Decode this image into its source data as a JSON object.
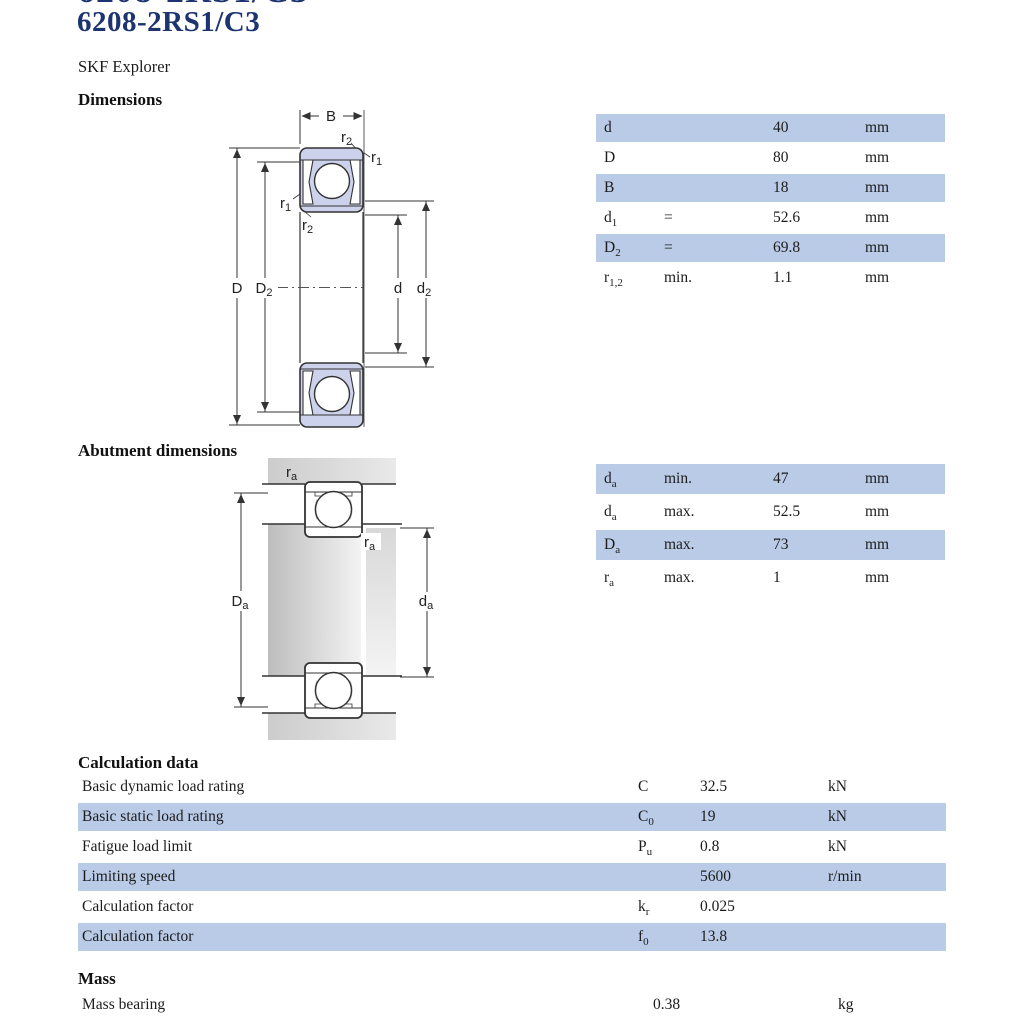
{
  "page": {
    "top_clipped_text": "6208-2RS1/C3",
    "title": "6208-2RS1/C3",
    "subtitle": "SKF Explorer"
  },
  "sections": {
    "dimensions": "Dimensions",
    "abutment": "Abutment dimensions",
    "calculation": "Calculation data",
    "mass": "Mass"
  },
  "colors": {
    "title_navy": "#1e3470",
    "row_highlight": "#b9cbe7",
    "drawing_fill": "#ccd2ec"
  },
  "figures": {
    "dimensions": {
      "labels": {
        "B": "B",
        "D": "D",
        "D2_base": "D",
        "D2_sub": "2",
        "d": "d",
        "d2_base": "d",
        "d2_sub": "2",
        "r1_base": "r",
        "r1_sub": "1",
        "r2_base": "r",
        "r2_sub": "2"
      }
    },
    "abutment": {
      "labels": {
        "Da_base": "D",
        "Da_sub": "a",
        "da_base": "d",
        "da_sub": "a",
        "ra_base": "r",
        "ra_sub": "a"
      }
    }
  },
  "tables": {
    "dimensions": {
      "rows": [
        {
          "sym": "d",
          "sub": "",
          "spec": "",
          "value": "40",
          "unit": "mm"
        },
        {
          "sym": "D",
          "sub": "",
          "spec": "",
          "value": "80",
          "unit": "mm"
        },
        {
          "sym": "B",
          "sub": "",
          "spec": "",
          "value": "18",
          "unit": "mm"
        },
        {
          "sym": "d",
          "sub": "1",
          "spec": "=",
          "value": "52.6",
          "unit": "mm"
        },
        {
          "sym": "D",
          "sub": "2",
          "spec": "=",
          "value": "69.8",
          "unit": "mm"
        },
        {
          "sym": "r",
          "sub": "1,2",
          "spec": "min.",
          "value": "1.1",
          "unit": "mm"
        }
      ]
    },
    "abutment": {
      "rows": [
        {
          "sym": "d",
          "sub": "a",
          "spec": "min.",
          "value": "47",
          "unit": "mm"
        },
        {
          "sym": "d",
          "sub": "a",
          "spec": "max.",
          "value": "52.5",
          "unit": "mm"
        },
        {
          "sym": "D",
          "sub": "a",
          "spec": "max.",
          "value": "73",
          "unit": "mm"
        },
        {
          "sym": "r",
          "sub": "a",
          "spec": "max.",
          "value": "1",
          "unit": "mm"
        }
      ]
    },
    "calculation": {
      "rows": [
        {
          "label": "Basic dynamic load rating",
          "sym": "C",
          "sub": "",
          "value": "32.5",
          "unit": "kN"
        },
        {
          "label": "Basic static load rating",
          "sym": "C",
          "sub": "0",
          "value": "19",
          "unit": "kN"
        },
        {
          "label": "Fatigue load limit",
          "sym": "P",
          "sub": "u",
          "value": "0.8",
          "unit": "kN"
        },
        {
          "label": "Limiting speed",
          "sym": "",
          "sub": "",
          "value": "5600",
          "unit": "r/min"
        },
        {
          "label": "Calculation factor",
          "sym": "k",
          "sub": "r",
          "value": "0.025",
          "unit": ""
        },
        {
          "label": "Calculation factor",
          "sym": "f",
          "sub": "0",
          "value": "13.8",
          "unit": ""
        }
      ]
    },
    "mass": {
      "row": {
        "label": "Mass bearing",
        "value": "0.38",
        "unit": "kg"
      }
    }
  }
}
